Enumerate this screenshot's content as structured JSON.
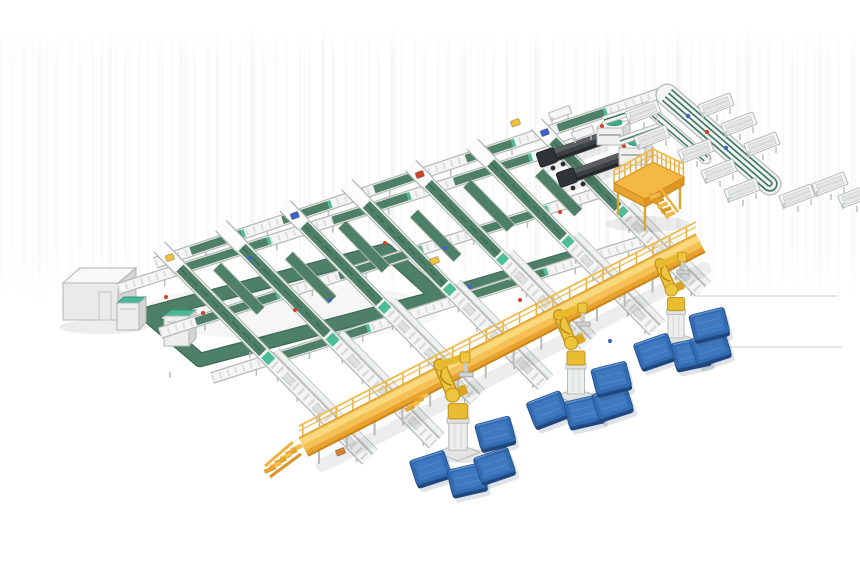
{
  "meta": {
    "description": "Isometric 3D render of an automated parcel sortation and robotic palletizing system on a white background",
    "background": "#ffffff"
  },
  "palette": {
    "frameFill": "#f4f5f4",
    "frameStroke": "#b4b9b7",
    "rollFill": "#d7dad8",
    "slat": "#c3c7c5",
    "beltGreen": "#4e7f68",
    "beltGreenDark": "#3c6757",
    "mint": "#4dbd97",
    "tealTop": "#47b795",
    "deckYellow": "#f5c156",
    "deckHighlight": "#f9d87e",
    "deckSide": "#e8a22e",
    "deckEdge": "#cb851a",
    "railYellow": "#f0ba4a",
    "robotYellow": "#eec53e",
    "robotShade": "#c2951d",
    "palletTop": "#336bb1",
    "palletInner": "#417ac2",
    "palletSide": "#1f477e",
    "loaderDark": "#3e4143",
    "loaderTop": "#5a5e61",
    "loaderLip": "#26282a",
    "redDot": "#d4442a",
    "blueDot": "#3f63c8",
    "orangeBox": "#e8892f",
    "yellowBox": "#f0c23c",
    "white": "#fbfcfb",
    "legGray": "#b9bdbb",
    "shadow": "rgba(100,105,100,0.12)"
  },
  "scene": {
    "counts": {
      "sorter_lanes": 7,
      "long_lines": 4,
      "palletizing_robots": 3,
      "pallets": 12,
      "truck_loaders": 2,
      "scanner_units": 2,
      "tray_stations": 11,
      "platforms": 2,
      "check_machines": 2,
      "control_cabins": 1
    },
    "spines": [
      {
        "x1": 155,
        "y1": 263,
        "x2": 665,
        "y2": 92,
        "belts": [
          [
            0.07,
            0.17
          ],
          [
            0.25,
            0.34
          ],
          [
            0.43,
            0.52
          ],
          [
            0.61,
            0.7
          ],
          [
            0.79,
            0.88
          ]
        ]
      },
      {
        "x1": 118,
        "y1": 289,
        "x2": 585,
        "y2": 140,
        "belts": [
          [
            0.12,
            0.32
          ],
          [
            0.46,
            0.62
          ],
          [
            0.72,
            0.88
          ]
        ]
      },
      {
        "x1": 160,
        "y1": 333,
        "x2": 608,
        "y2": 190,
        "belts": [
          [
            0.08,
            0.26
          ],
          [
            0.4,
            0.58
          ],
          [
            0.7,
            0.86
          ]
        ]
      },
      {
        "x1": 212,
        "y1": 378,
        "x2": 655,
        "y2": 237,
        "belts": [
          [
            0.15,
            0.35
          ],
          [
            0.55,
            0.75
          ]
        ]
      }
    ],
    "lanes": [
      {
        "x": 170,
        "y": 258,
        "len": 282,
        "item": "#f0c23c"
      },
      {
        "x": 232,
        "y": 237,
        "len": 289,
        "item": null
      },
      {
        "x": 295,
        "y": 216,
        "len": 257,
        "item": "#3f63c8"
      },
      {
        "x": 357,
        "y": 195,
        "len": 266,
        "item": null
      },
      {
        "x": 420,
        "y": 175,
        "len": 237,
        "item": "#d4442a"
      },
      {
        "x": 482,
        "y": 154,
        "len": 247,
        "item": null
      },
      {
        "x": 545,
        "y": 133,
        "len": 222,
        "item": "#3f63c8"
      }
    ],
    "crossBelts": [
      {
        "x": 199,
        "y": 248,
        "from": 26,
        "to": 88
      },
      {
        "x": 261,
        "y": 227,
        "from": 40,
        "to": 102
      },
      {
        "x": 324,
        "y": 206,
        "from": 26,
        "to": 88
      },
      {
        "x": 386,
        "y": 185,
        "from": 40,
        "to": 102
      },
      {
        "x": 449,
        "y": 165,
        "from": 26,
        "to": 88
      },
      {
        "x": 511,
        "y": 144,
        "from": 40,
        "to": 96
      }
    ],
    "loop": {
      "pts": [
        [
          146,
          314
        ],
        [
          386,
          250
        ],
        [
          438,
          297
        ],
        [
          200,
          360
        ]
      ]
    },
    "loopExt": {
      "x1": 440,
      "y1": 296,
      "x2": 575,
      "y2": 256
    },
    "cabin": {
      "x": 63,
      "y": 283,
      "w": 55,
      "h": 37
    },
    "machines": [
      {
        "x": 117,
        "y": 303,
        "w": 22,
        "h": 27
      },
      {
        "x": 164,
        "y": 316,
        "w": 25,
        "h": 30
      }
    ],
    "loaders": [
      {
        "x1": 547,
        "y1": 158,
        "x2": 604,
        "y2": 138
      },
      {
        "x1": 567,
        "y1": 178,
        "x2": 626,
        "y2": 157
      }
    ],
    "dws": [
      {
        "x": 610,
        "y": 131
      },
      {
        "x": 632,
        "y": 151
      }
    ],
    "benches": [
      [
        560,
        113
      ],
      [
        583,
        133
      ]
    ],
    "spurs": [
      {
        "x1": 604,
        "y1": 120,
        "x2": 650,
        "y2": 105
      },
      {
        "x1": 620,
        "y1": 141,
        "x2": 666,
        "y2": 125
      }
    ],
    "returnBand": {
      "x1": 667,
      "y1": 95,
      "x2": 770,
      "y2": 184
    },
    "miniBand": {
      "x1": 654,
      "y1": 114,
      "x2": 706,
      "y2": 159
    },
    "bandDots": [
      [
        688,
        116,
        "#3f63c8"
      ],
      [
        707,
        132,
        "#d4442a"
      ],
      [
        726,
        148,
        "#3f63c8"
      ]
    ],
    "stations": [
      [
        643,
        112
      ],
      [
        652,
        137
      ],
      [
        716,
        105
      ],
      [
        739,
        124
      ],
      [
        762,
        144
      ],
      [
        696,
        151
      ],
      [
        719,
        171
      ],
      [
        742,
        190
      ],
      [
        797,
        196
      ],
      [
        830,
        184
      ],
      [
        856,
        196
      ]
    ],
    "platform": {
      "deck": [
        [
          614,
          183
        ],
        [
          653,
          162
        ],
        [
          684,
          177
        ],
        [
          645,
          199
        ]
      ],
      "faceL": [
        [
          614,
          183
        ],
        [
          645,
          199
        ],
        [
          645,
          207
        ],
        [
          614,
          191
        ]
      ],
      "faceR": [
        [
          645,
          199
        ],
        [
          684,
          177
        ],
        [
          684,
          185
        ],
        [
          645,
          207
        ]
      ],
      "legs": [
        [
          618,
          189,
          618,
          215
        ],
        [
          645,
          206,
          645,
          231
        ],
        [
          680,
          184,
          680,
          209
        ],
        [
          660,
          172,
          660,
          196
        ]
      ],
      "stairX": 655,
      "stairY": 196
    },
    "walkway": {
      "x1": 303,
      "y1": 446,
      "x2": 700,
      "y2": 242,
      "midStairT": 0.3
    },
    "robots": [
      {
        "x": 458,
        "y": 448,
        "s": 1.08
      },
      {
        "x": 576,
        "y": 392,
        "s": 1.0
      },
      {
        "x": 676,
        "y": 336,
        "s": 0.94
      }
    ],
    "pallets": [
      [
        430,
        467,
        -18
      ],
      [
        467,
        478,
        -13
      ],
      [
        494,
        464,
        -19
      ],
      [
        495,
        432,
        -15
      ],
      [
        547,
        408,
        -21
      ],
      [
        584,
        410,
        -13
      ],
      [
        612,
        401,
        -18
      ],
      [
        611,
        377,
        -14
      ],
      [
        654,
        350,
        -19
      ],
      [
        691,
        352,
        -12
      ],
      [
        710,
        346,
        -18
      ],
      [
        709,
        323,
        -14
      ]
    ],
    "boxes": [
      [
        515,
        123,
        "#f0c23c"
      ],
      [
        340,
        452,
        "#e8892f"
      ],
      [
        434,
        261,
        "#f0c23c"
      ]
    ],
    "dots": [
      [
        166,
        297,
        "#d4442a"
      ],
      [
        203,
        313,
        "#d4442a"
      ],
      [
        295,
        310,
        "#d4442a"
      ],
      [
        385,
        243,
        "#d4442a"
      ],
      [
        560,
        212,
        "#d4442a"
      ],
      [
        620,
        186,
        "#d4442a"
      ],
      [
        520,
        300,
        "#d4442a"
      ],
      [
        250,
        258,
        "#3f63c8"
      ],
      [
        330,
        300,
        "#3f63c8"
      ],
      [
        445,
        248,
        "#3f63c8"
      ],
      [
        470,
        287,
        "#3f63c8"
      ],
      [
        610,
        341,
        "#3f63c8"
      ]
    ],
    "floorLines": [
      [
        697,
        296,
        838,
        296
      ],
      [
        718,
        347,
        842,
        347
      ]
    ]
  }
}
